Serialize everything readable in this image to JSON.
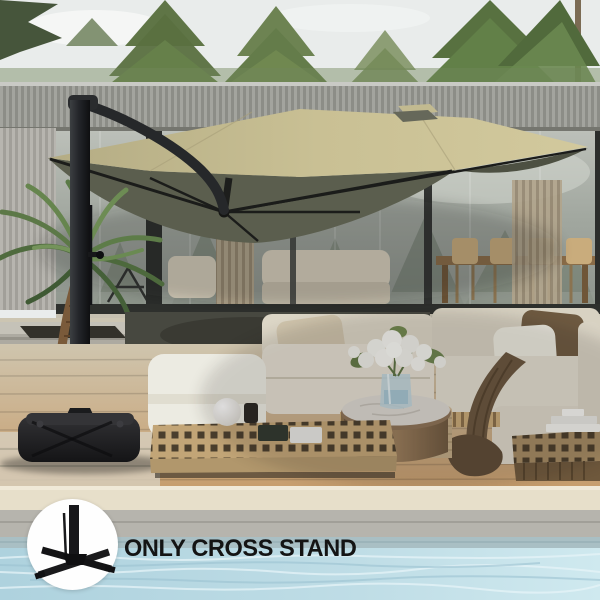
{
  "image": {
    "kind": "product-photo",
    "subject": "tan cantilever patio umbrella with black frame over an outdoor cream sectional sofa set on a wood deck beside a pool, modern glass house behind"
  },
  "overlay": {
    "caption": "ONLY CROSS STAND",
    "icon": "cross-stand-icon",
    "circle_bg": "#fefefe",
    "text_color": "#141414"
  },
  "palette": {
    "sky": "#e9ecec",
    "trees": "#5d7546",
    "house_slats": "#9a9b95",
    "glass": "#a3a89f",
    "canopy_top": "#c6bd92",
    "canopy_underside": "#5b5e4e",
    "umbrella_frame": "#232528",
    "umbrella_base": "#1c1c1e",
    "sofa_cushion": "#e4dfd2",
    "brown_pillow": "#6e5a41",
    "wood_table": "#c0a376",
    "deck": "#c9ab7e",
    "pool_coping": "#e7dfca",
    "pool_water": "#bcdbe4"
  },
  "objects": [
    "cantilever-umbrella",
    "black-pole",
    "cross-base-with-cover",
    "palm-plant",
    "glass-house",
    "dining-set-indoors",
    "outdoor-sectional-sofa",
    "ottoman",
    "lattice-coffee-table",
    "round-marble-table",
    "flower-bouquet",
    "sphere-lamp",
    "books",
    "throw-blanket",
    "wood-deck",
    "pool"
  ]
}
